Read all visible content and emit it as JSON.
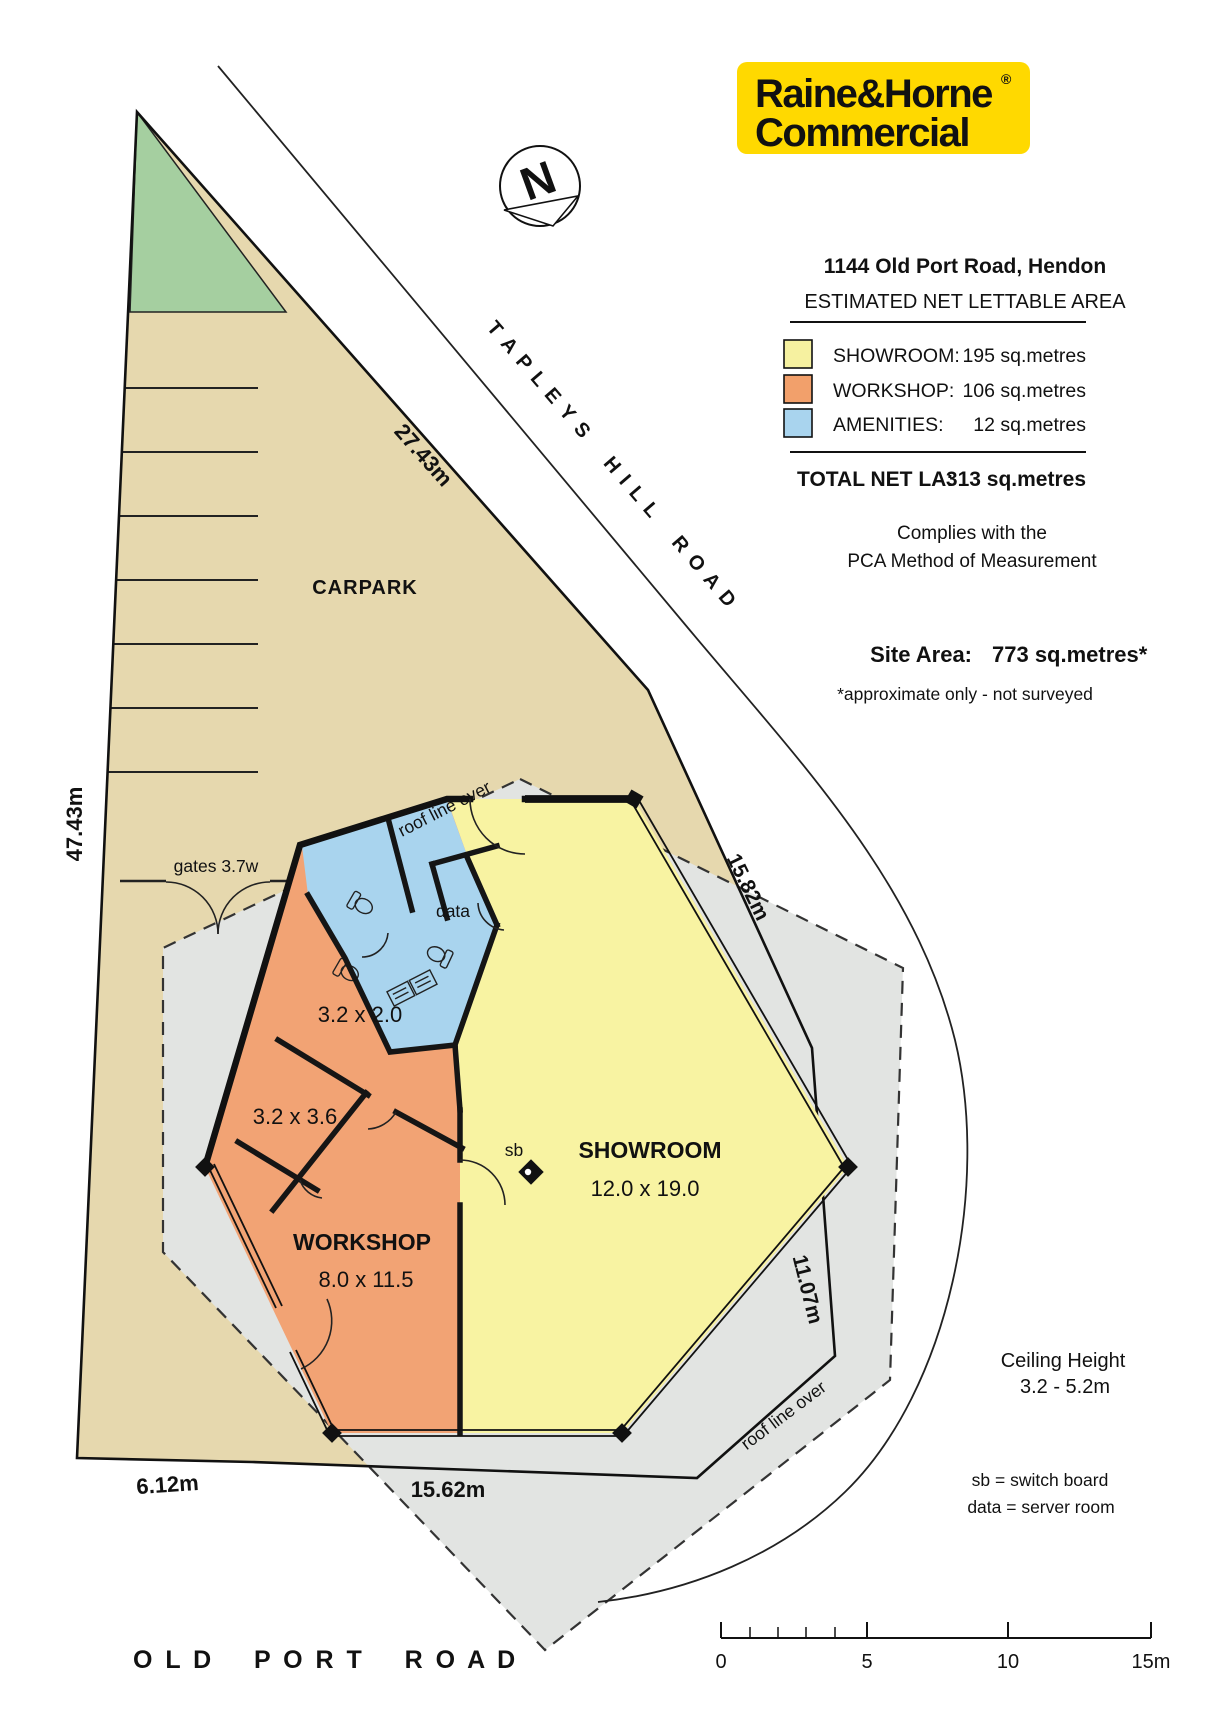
{
  "logo": {
    "line1": "Raine&Horne",
    "registered": "®",
    "line2": "Commercial",
    "bg_color": "#FFD900"
  },
  "north": {
    "label": "N"
  },
  "header": {
    "address": "1144 Old Port Road, Hendon",
    "subtitle": "ESTIMATED NET LETTABLE AREA"
  },
  "legend": {
    "rows": [
      {
        "label": "SHOWROOM:",
        "value": "195 sq.metres",
        "color": "#F6F1A0"
      },
      {
        "label": "WORKSHOP:",
        "value": "106 sq.metres",
        "color": "#F2A06B"
      },
      {
        "label": "AMENITIES:",
        "value": "12 sq.metres",
        "color": "#A9D4EE"
      }
    ],
    "total_label": "TOTAL NET LA:",
    "total_value": "313 sq.metres",
    "compliance_line1": "Complies with the",
    "compliance_line2": "PCA Method of Measurement",
    "site_area_label": "Site Area:",
    "site_area_value": "773 sq.metres*",
    "site_area_note": "*approximate only - not surveyed"
  },
  "site": {
    "carpark_label": "CARPARK",
    "gates_label": "gates 3.7w",
    "road_tapleys": "T A P L E Y S    H I L L    R O A D",
    "road_old_port": "O L D    P O R T    R O A D",
    "dim_ne": "27.43m",
    "dim_west": "47.43m",
    "dim_se_upper": "15.82m",
    "dim_se_lower": "11.07m",
    "dim_south_main": "15.62m",
    "dim_south_west": "6.12m"
  },
  "building": {
    "showroom_name": "SHOWROOM",
    "showroom_size": "12.0 x 19.0",
    "workshop_name": "WORKSHOP",
    "workshop_size": "8.0 x 11.5",
    "room1": "3.2 x 2.0",
    "room2": "3.2 x 3.6",
    "data_label": "data",
    "sb_label": "sb",
    "roof_label_top": "roof line over",
    "roof_label_bottom": "roof line over"
  },
  "notes": {
    "ceiling_line1": "Ceiling Height",
    "ceiling_line2": "3.2 - 5.2m",
    "sb_note": "sb = switch board",
    "data_note": "data = server room"
  },
  "scalebar": {
    "t0": "0",
    "t5": "5",
    "t10": "10",
    "t15": "15m"
  }
}
